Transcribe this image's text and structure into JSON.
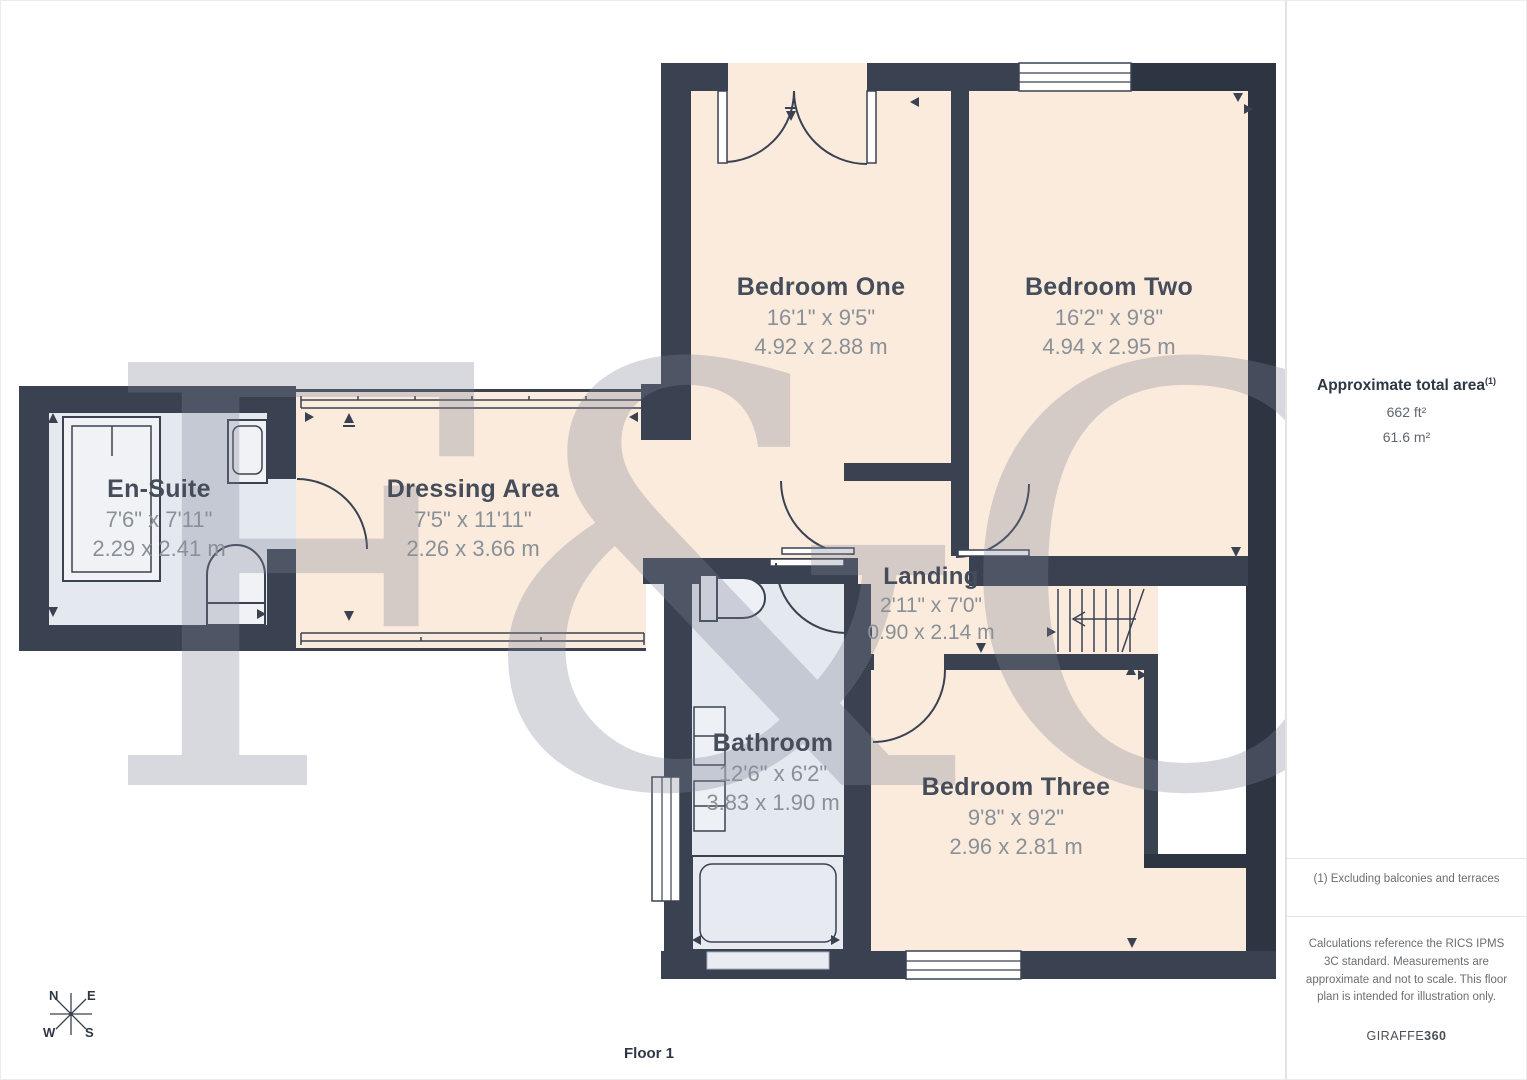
{
  "plan": {
    "floor_label": "Floor 1",
    "watermark": "F&C",
    "compass": {
      "north": "N",
      "east": "E",
      "west": "W",
      "south": "S"
    },
    "rooms": [
      {
        "id": "bedroom-one",
        "name": "Bedroom One",
        "size_imperial": "16'1\" x 9'5\"",
        "size_metric": "4.92 x 2.88 m"
      },
      {
        "id": "bedroom-two",
        "name": "Bedroom Two",
        "size_imperial": "16'2\" x 9'8\"",
        "size_metric": "4.94 x 2.95 m"
      },
      {
        "id": "en-suite",
        "name": "En-Suite",
        "size_imperial": "7'6\" x 7'11\"",
        "size_metric": "2.29 x 2.41 m"
      },
      {
        "id": "dressing-area",
        "name": "Dressing Area",
        "size_imperial": "7'5\" x 11'11\"",
        "size_metric": "2.26 x 3.66 m"
      },
      {
        "id": "landing",
        "name": "Landing",
        "size_imperial": "2'11\" x 7'0\"",
        "size_metric": "0.90 x 2.14 m"
      },
      {
        "id": "bathroom",
        "name": "Bathroom",
        "size_imperial": "12'6\" x 6'2\"",
        "size_metric": "3.83 x 1.90 m"
      },
      {
        "id": "bedroom-three",
        "name": "Bedroom Three",
        "size_imperial": "9'8\" x 9'2\"",
        "size_metric": "2.96 x 2.81 m"
      }
    ]
  },
  "sidebar": {
    "area_title": "Approximate total area",
    "area_footnote_marker": "(1)",
    "area_imperial": "662 ft²",
    "area_metric": "61.6 m²",
    "footnote": "(1) Excluding balconies and terraces",
    "disclaimer": "Calculations reference the RICS IPMS 3C standard. Measurements are approximate and not to scale. This floor plan is intended for illustration only.",
    "brand_name": "GIRAFFE",
    "brand_suffix": "360"
  },
  "colors": {
    "wall": "#3A4251",
    "wall_dark": "#2E3542",
    "room_warm": "#FBEBDC",
    "room_wet": "#E4E8EF",
    "label_text": "#454C5A",
    "dim_text": "#8A9097"
  }
}
